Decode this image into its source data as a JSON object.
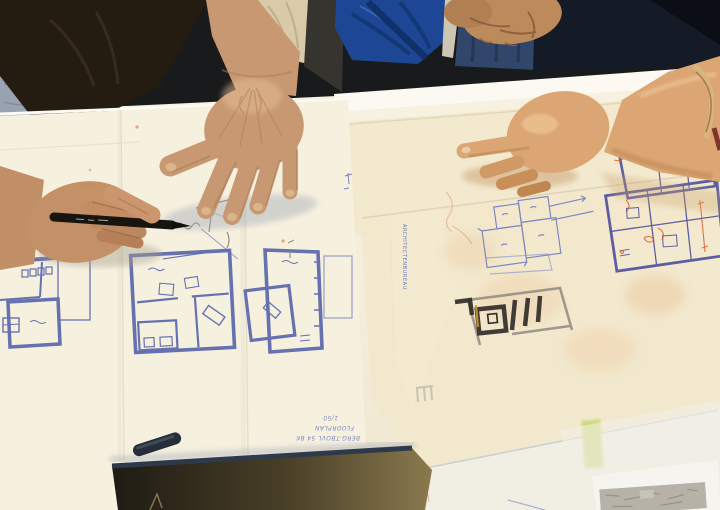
{
  "annotations": {
    "plan_note": {
      "line1": "BERG-TBOVL 54 BK",
      "line2": "FLOORPLAN",
      "line3": "1/50"
    },
    "side_label": "ARCHITECTENBUREAU"
  },
  "palette": {
    "paper_warm": "#f5efdf",
    "paper_white": "#f4f2ea",
    "tracing_cream": "#f1e6c9",
    "blueprint_ink": "#5a67ad",
    "violet_ink": "#4c4f9e",
    "red_marker": "#d4562a",
    "pencil_gray": "#84817a",
    "skin_man": "#c79871",
    "skin_woman": "#dba674",
    "denim_blue": "#31466b",
    "bag_blue": "#1d4794",
    "shirt_dark": "#251c11",
    "sofa_gray": "#99a2b1",
    "portfolio_dark": "#1f1b14",
    "portfolio_gold": "#7e6f45",
    "portfolio_edge_navy": "#2e3a4c",
    "pen_black": "#181511",
    "bangle_gold": "#d6b67c"
  }
}
